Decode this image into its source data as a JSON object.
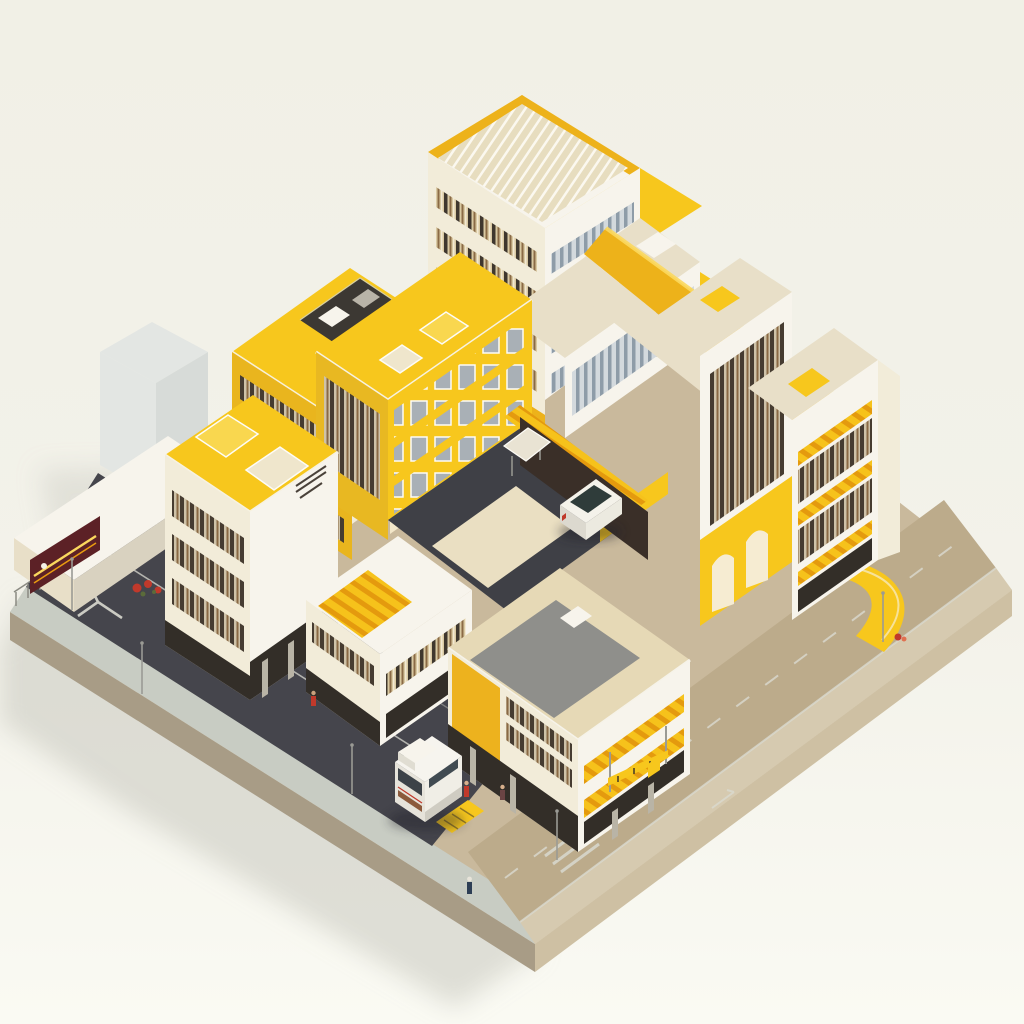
{
  "scene": {
    "type": "isometric-architectural-render",
    "subject": "yellow and cream building complex on a square base plate with streets",
    "vehicles": [
      "white-car",
      "white-van"
    ],
    "pedestrian_count": 4,
    "signage_text_legible": false
  },
  "colors": {
    "bg": "#f2f1e8",
    "bgBottom": "#fafaf3",
    "shadow": "#c9c9c0",
    "plateTop": "#c9b99c",
    "plateSideLeft": "#a89c86",
    "plateSideRight": "#cec0a3",
    "sidewalkLeft": "#c8ccc3",
    "sidewalkRight": "#d6cab0",
    "asphalt": "#45454c",
    "asphaltDark": "#3f4046",
    "roadTan": "#bcab8b",
    "yellow": "#f7c71d",
    "yellowDeep": "#edb21a",
    "yellowPale": "#fbd85e",
    "amber": "#e89b10",
    "cream": "#f2ecd9",
    "creamDark": "#e8dfc8",
    "white": "#f7f4ec",
    "roofTan": "#e6d9b6",
    "roofGray": "#8f8f8b",
    "windowDark": "#3e362e",
    "windowBrown": "#7b5a3b",
    "glass": "#9aa6b1",
    "glassLight": "#ccd4da",
    "maroon": "#5c2126",
    "red": "#c0392b",
    "metal": "#9a9a94",
    "darkBase": "#332e28",
    "cube": "#e3e6e3",
    "cubeSide": "#d7dbd8",
    "marking": "#d9d9d0"
  }
}
